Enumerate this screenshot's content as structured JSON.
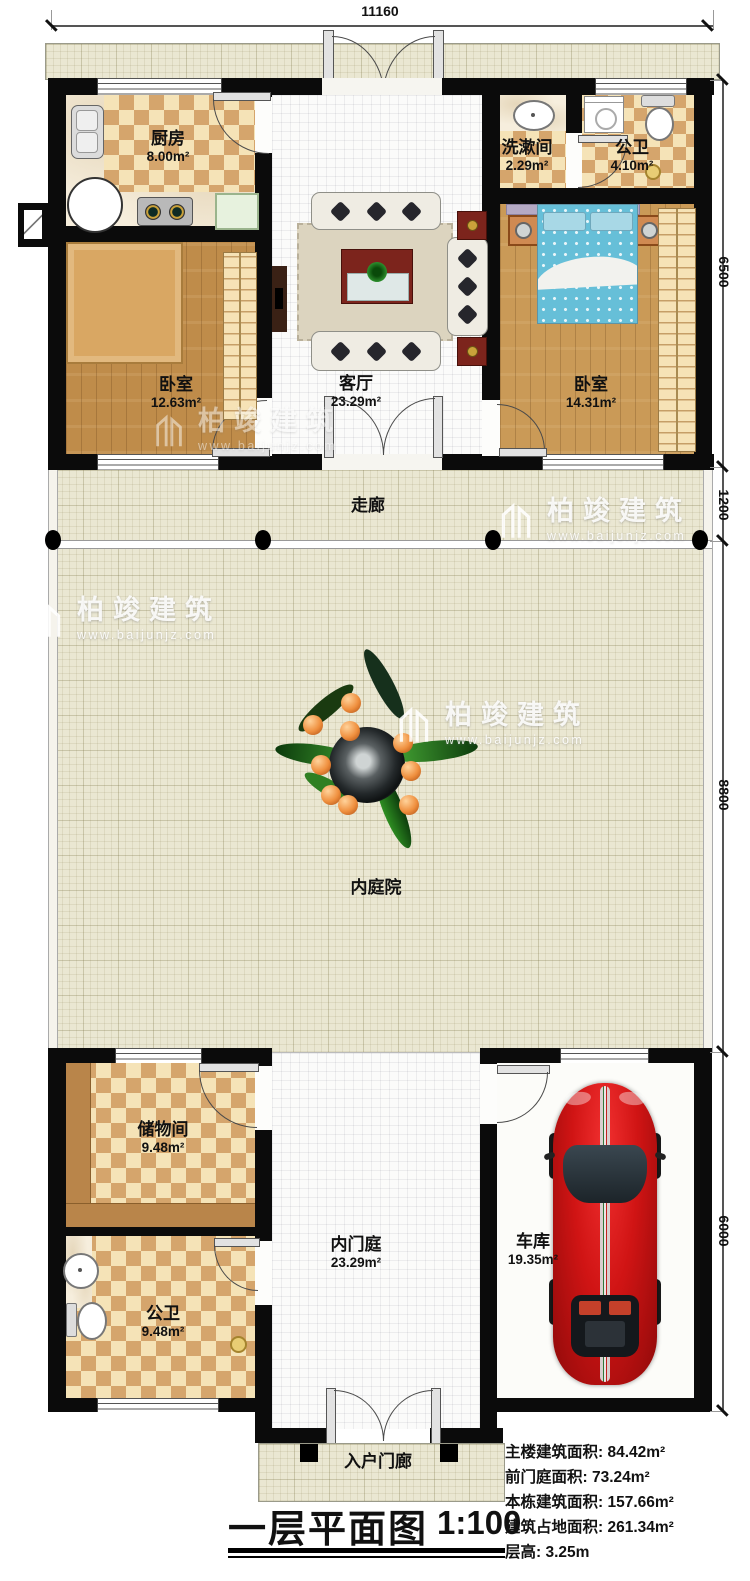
{
  "dimensions": {
    "top": "11160",
    "right": [
      {
        "v": "6500"
      },
      {
        "v": "1200"
      },
      {
        "v": "8800"
      },
      {
        "v": "6000"
      }
    ]
  },
  "rooms": {
    "kitchen": {
      "name": "厨房",
      "area": "8.00m²"
    },
    "washroom": {
      "name": "洗漱间",
      "area": "2.29m²"
    },
    "bath_top": {
      "name": "公卫",
      "area": "4.10m²"
    },
    "bedroom_left": {
      "name": "卧室",
      "area": "12.63m²"
    },
    "living": {
      "name": "客厅",
      "area": "23.29m²"
    },
    "bedroom_right": {
      "name": "卧室",
      "area": "14.31m²"
    },
    "corridor": {
      "name": "走廊"
    },
    "courtyard": {
      "name": "内庭院"
    },
    "storage": {
      "name": "储物间",
      "area": "9.48m²"
    },
    "bath_bottom": {
      "name": "公卫",
      "area": "9.48m²"
    },
    "inner_court": {
      "name": "内门庭",
      "area": "23.29m²"
    },
    "garage": {
      "name": "车库",
      "area": "19.35m²"
    },
    "entry_porch": {
      "name": "入户门廊"
    }
  },
  "title_block": {
    "title": "一层平面图",
    "scale": "1:100"
  },
  "stats": [
    {
      "text": "主楼建筑面积: 84.42m²"
    },
    {
      "text": "前门庭面积: 73.24m²"
    },
    {
      "text": "本栋建筑面积: 157.66m²"
    },
    {
      "text": "建筑占地面积: 261.34m²"
    },
    {
      "text": "层高: 3.25m"
    }
  ],
  "watermark": {
    "brand": "柏竣建筑",
    "site": "www.baijunjz.com"
  }
}
